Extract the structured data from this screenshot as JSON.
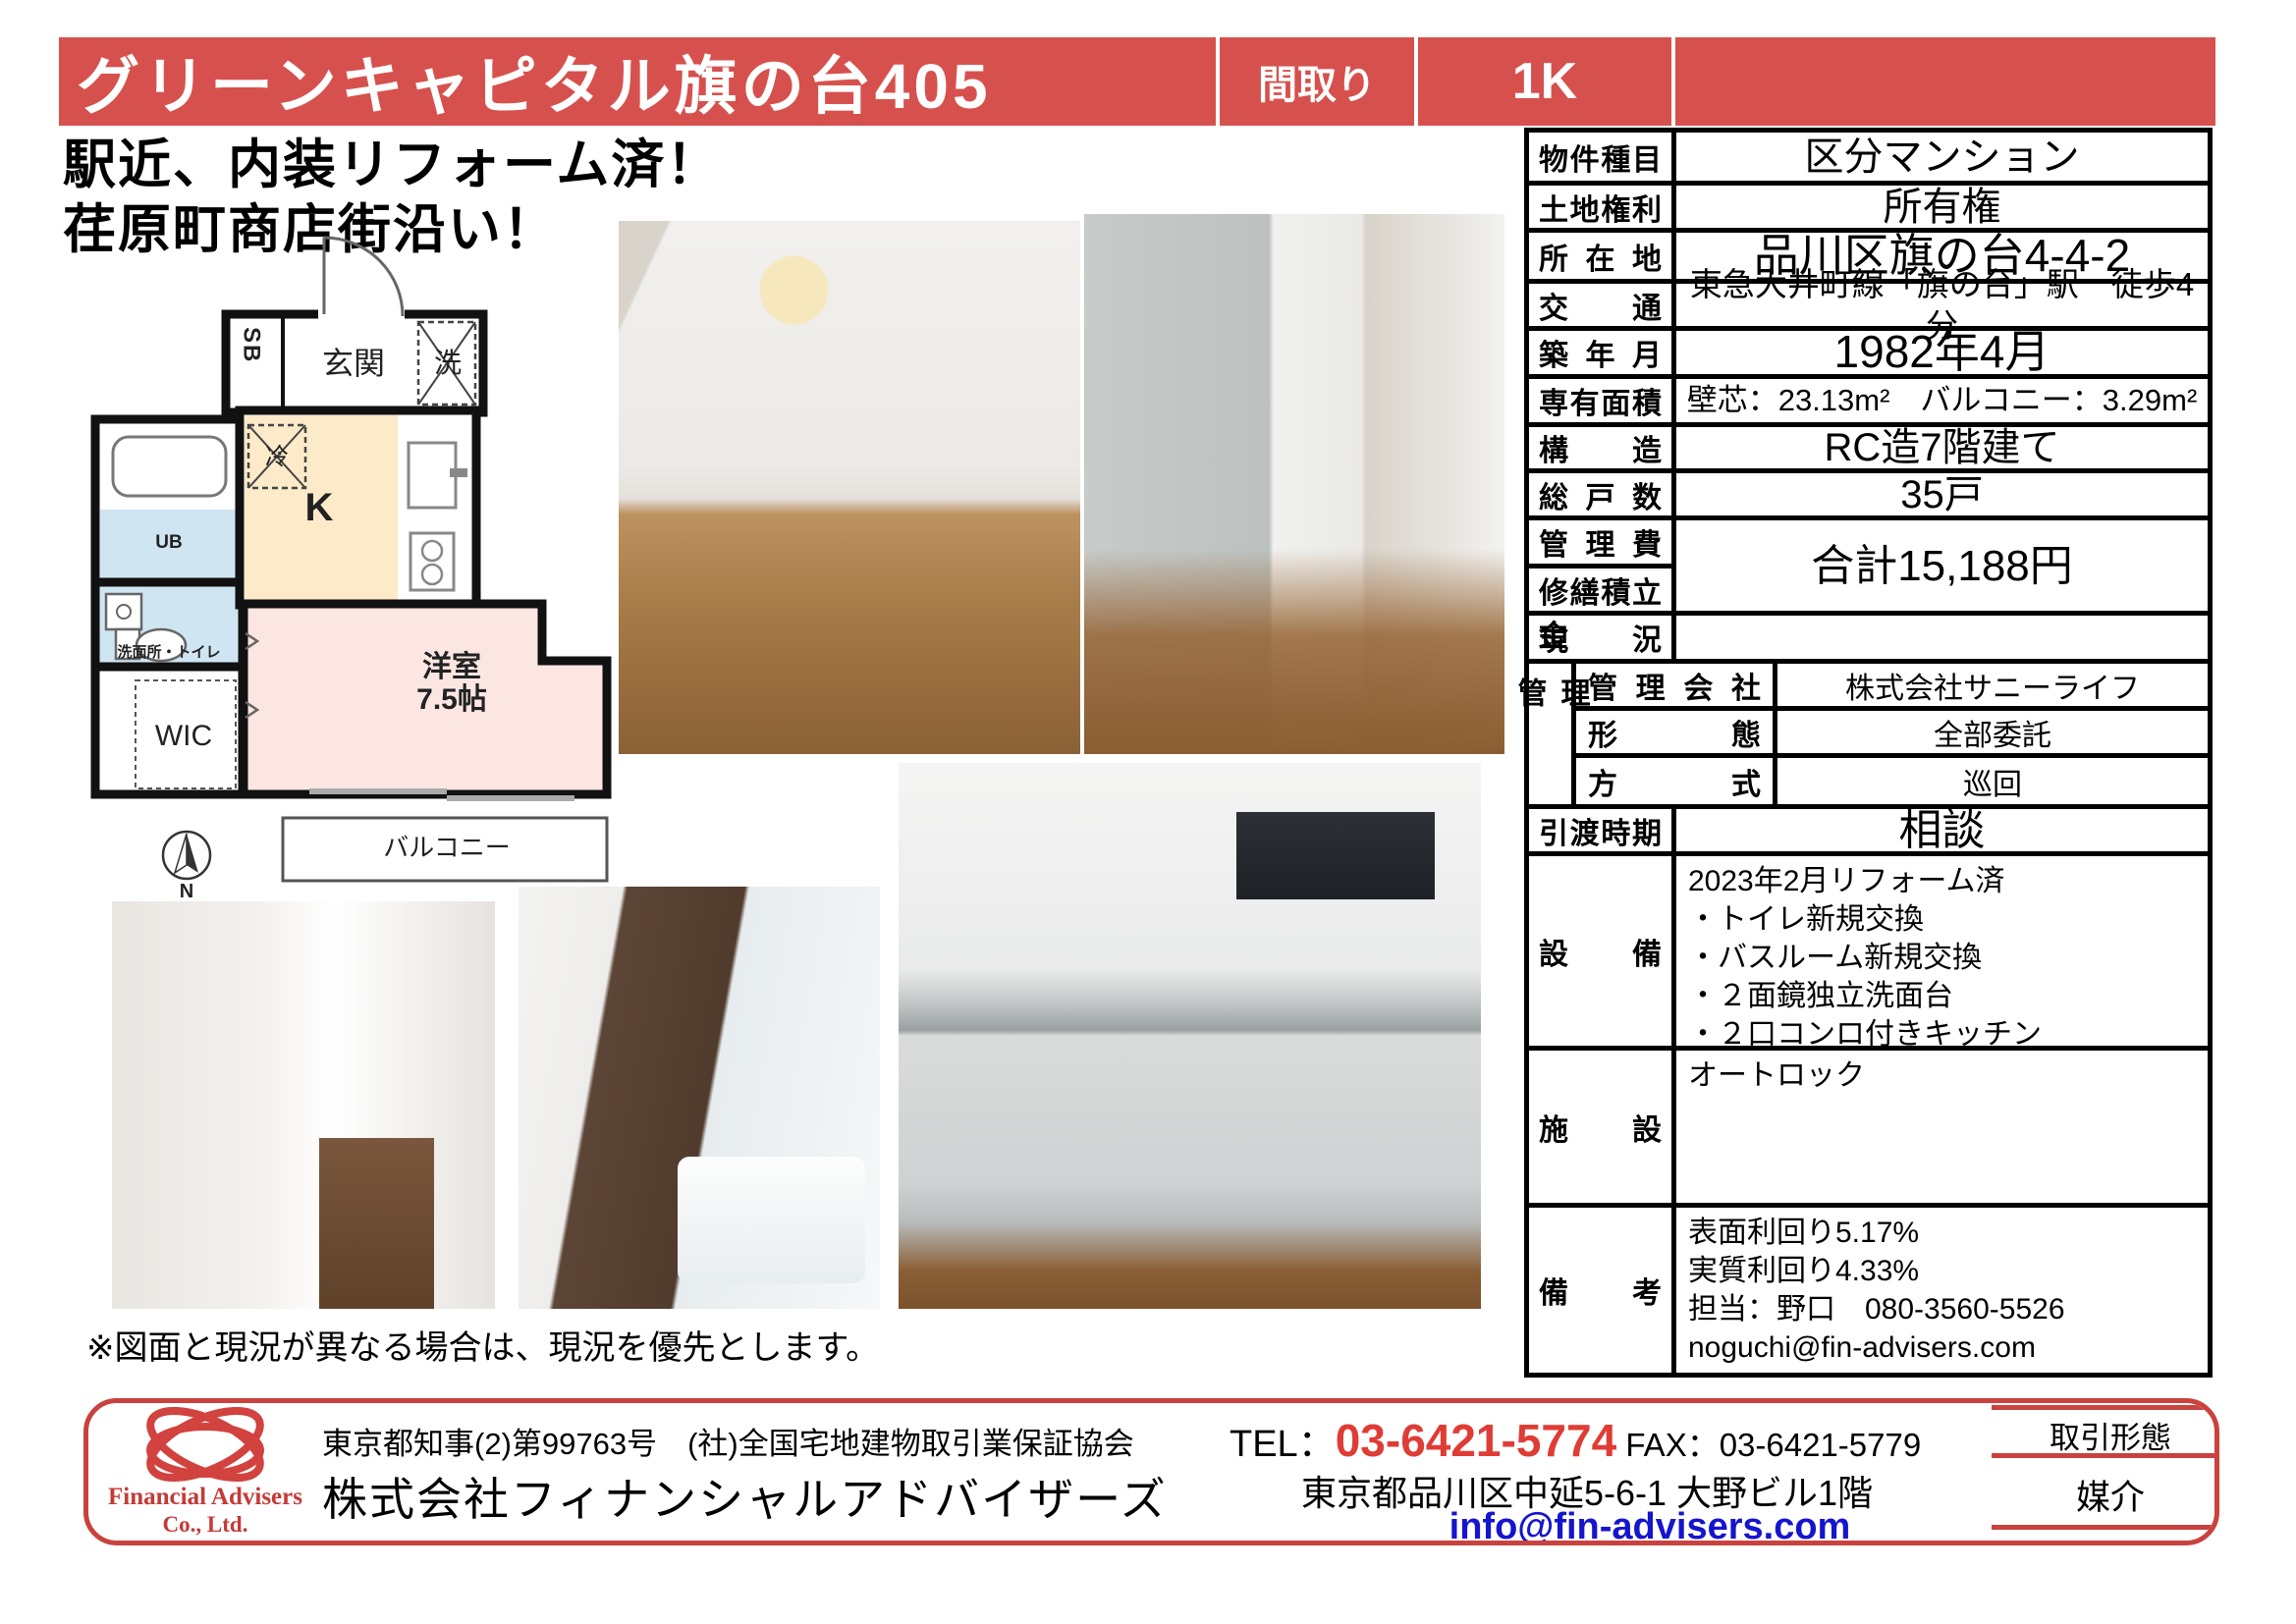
{
  "banner": {
    "title": "グリーンキャピタル旗の台405",
    "madori_label": "間取り",
    "layout_value": "1K"
  },
  "catchphrase": "駅近、内装リフォーム済！\n荏原町商店街沿い！",
  "floorplan": {
    "labels": {
      "sb": "SB",
      "genkan": "玄関",
      "laundry": "洗",
      "fridge": "冷",
      "kitchen": "K",
      "ub": "UB",
      "washroom_toilet": "洗面所・トイレ",
      "wic": "WIC",
      "main_room": "洋室\n7.5帖",
      "balcony": "バルコニー",
      "north": "N"
    }
  },
  "note": "※図面と現況が異なる場合は、現況を優先とします。",
  "spec_table": {
    "property_type": {
      "label": "物件種目",
      "value": "区分マンション"
    },
    "land_rights": {
      "label": "土地権利",
      "value": "所有権"
    },
    "location": {
      "label": "所在地",
      "value": "品川区旗の台4-4-2"
    },
    "access": {
      "label": "交通",
      "value": "東急大井町線「旗の台」駅　徒歩4分"
    },
    "built": {
      "label": "築年月",
      "value": "1982年4月"
    },
    "area": {
      "label": "専有面積",
      "value": "壁芯：23.13m²　バルコニー：3.29m²"
    },
    "structure": {
      "label": "構造",
      "value": "RC造7階建て"
    },
    "units": {
      "label": "総戸数",
      "value": "35戸"
    },
    "mgmt_fee_label": "管理費",
    "repair_fund_label": "修繕積立金",
    "fees_value": "合計15,188円",
    "current_status": {
      "label": "現況",
      "value": ""
    },
    "management": {
      "side": "管理",
      "company_label": "管理会社",
      "company": "株式会社サニーライフ",
      "form_label": "形態",
      "form": "全部委託",
      "method_label": "方式",
      "method": "巡回"
    },
    "handover": {
      "label": "引渡時期",
      "value": "相談"
    },
    "equipment": {
      "label": "設備",
      "value": "2023年2月リフォーム済\n・トイレ新規交換\n・バスルーム新規交換\n・２面鏡独立洗面台\n・２口コンロ付きキッチン"
    },
    "facility": {
      "label": "施設",
      "value": "オートロック"
    },
    "remarks": {
      "label": "備考",
      "value": "表面利回り5.17%\n実質利回り4.33%\n担当：野口　080-3560-5526\nnoguchi@fin-advisers.com"
    }
  },
  "footer": {
    "logo_line1": "Financial Advisers",
    "logo_line2": "Co., Ltd.",
    "license": "東京都知事(2)第99763号　(社)全国宅地建物取引業保証協会",
    "company": "株式会社フィナンシャルアドバイザーズ",
    "tel_label": "TEL：",
    "tel": "03-6421-5774",
    "fax_label": " FAX：",
    "fax": "03-6421-5779",
    "address": "東京都品川区中延5-6-1 大野ビル1階",
    "email": "info@fin-advisers.com",
    "deal_type_label": "取引形態",
    "deal_type": "媒介"
  },
  "colors": {
    "accent_red": "#d6514d",
    "footer_border_red": "#c9423e",
    "tel_red": "#e03c36",
    "link_blue": "#1515cd",
    "kitchen_room_fill": "#fdeac9",
    "western_room_fill": "#fce6e2",
    "wet_area_fill": "#cfe5f2"
  }
}
